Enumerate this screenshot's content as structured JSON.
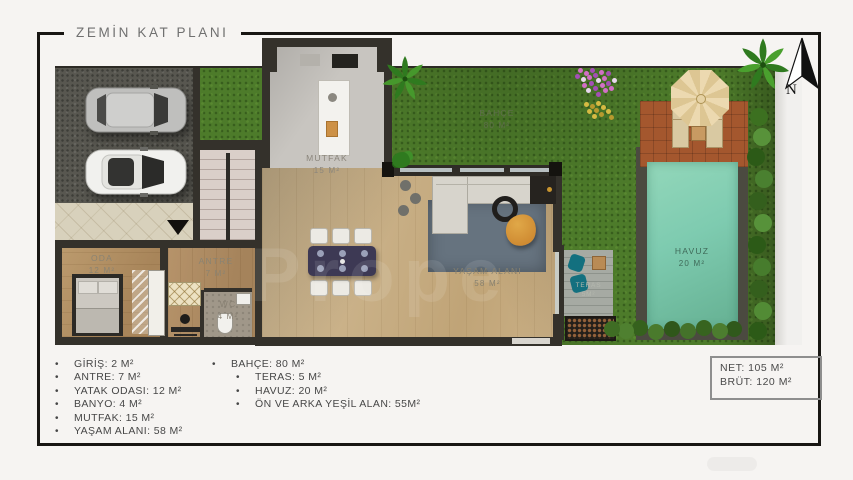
{
  "title": "ZEMİN KAT PLANI",
  "compass_label": "N",
  "watermark": "Prope",
  "plan": {
    "rooms": [
      {
        "name": "MUTFAK",
        "area": "15 M²"
      },
      {
        "name": "BAHÇE",
        "area": "80 M²"
      },
      {
        "name": "HAVUZ",
        "area": "20 M²"
      },
      {
        "name": "YAŞAM ALANI",
        "area": "58 M²"
      },
      {
        "name": "ODA",
        "area": "12 M²"
      },
      {
        "name": "ANTRE",
        "area": "7 M²"
      },
      {
        "name": "WC",
        "area": "4 M²"
      },
      {
        "name": "TERAS",
        "area": "5M²"
      }
    ]
  },
  "legend": {
    "rooms": [
      "GİRİŞ: 2 M²",
      "ANTRE: 7 M²",
      "YATAK ODASI: 12 M²",
      "BANYO: 4 M²",
      "MUTFAK: 15 M²",
      "YAŞAM ALANI: 58 M²"
    ],
    "outdoor_parent": "BAHÇE: 80 M²",
    "outdoor_children": [
      "TERAS: 5 M²",
      "HAVUZ: 20 M²",
      "ÖN VE ARKA YEŞİL ALAN: 55M²"
    ]
  },
  "summary": {
    "net": "NET: 105 M²",
    "brut": "BRÜT: 120 M²"
  },
  "colors": {
    "grass": "#4d7b2a",
    "pool": "#7ecbb0",
    "pool_deck": "#4b4a40",
    "terracotta": "#a4572e",
    "wood_floor": "#ccb58f",
    "wall": "#34312b",
    "umbrella": "#e9d6ac",
    "accent_teal": "#13707f",
    "rug": "#66737f"
  }
}
